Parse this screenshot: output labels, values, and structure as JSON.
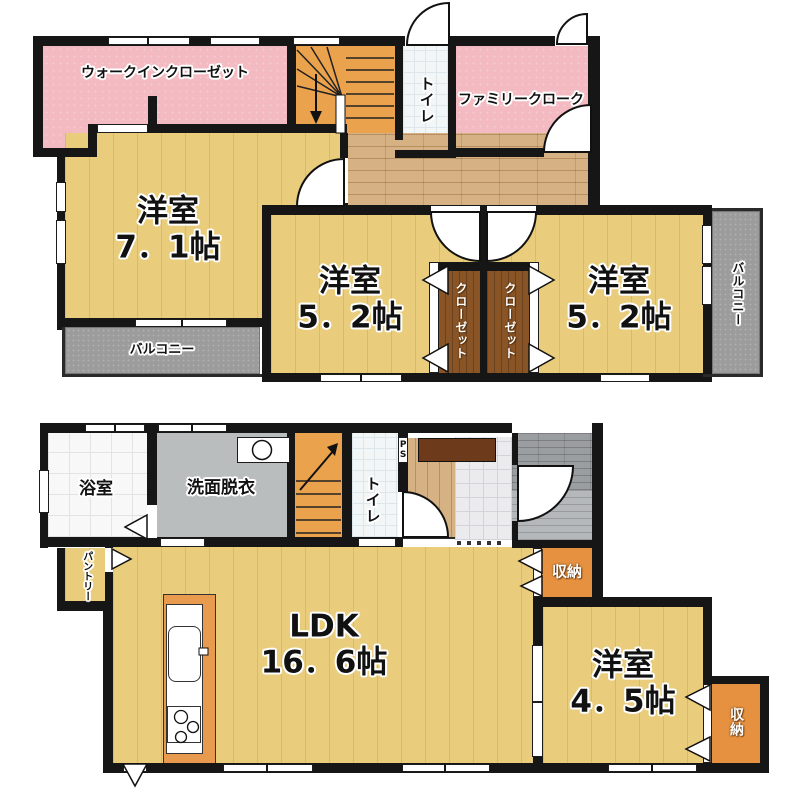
{
  "second": {
    "wic": "ウォークインクローゼット",
    "toilet": "トイレ",
    "family_cloak": "ファミリークローク",
    "room71": {
      "name": "洋室",
      "size": "7．1帖"
    },
    "room52_left": {
      "name": "洋室",
      "size": "5．2帖"
    },
    "room52_right": {
      "name": "洋室",
      "size": "5．2帖"
    },
    "closet_left": "クローゼット",
    "closet_right": "クローゼット",
    "balcony_left": "バルコニー",
    "balcony_right": "バルコニー"
  },
  "first": {
    "bath": "浴室",
    "washroom": "洗面脱衣",
    "toilet": "トイレ",
    "ps": "PS",
    "pantry": "パントリー",
    "ldk": {
      "name": "LDK",
      "size": "16．6帖"
    },
    "room45": {
      "name": "洋室",
      "size": "4．5帖"
    },
    "storage_entry": "収納",
    "storage_room": "収納"
  },
  "colors": {
    "wall": "#161616",
    "floor_yellow": "#e9cd7c",
    "closet_pink": "#f3bac2",
    "stairs_orange": "#eba24d",
    "hall_wood": "#d6b184",
    "closet_wood": "#8a5526",
    "storage_orange": "#e69140",
    "balcony_gray": "#9c9c9c",
    "washroom_gray": "#b9bdbd"
  }
}
